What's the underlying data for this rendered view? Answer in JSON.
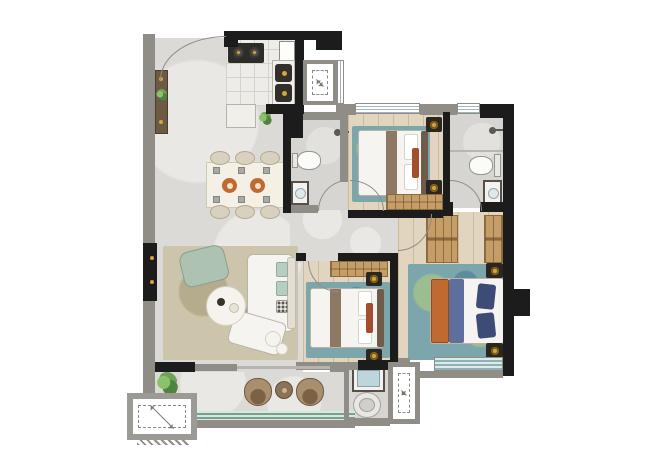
{
  "meta": {
    "type": "residential-floor-plan",
    "canvas": {
      "width": 651,
      "height": 460
    },
    "visible_text": "none"
  },
  "colors": {
    "wall-black": "#1c1c1c",
    "wall-gray": "#8f8d86",
    "floor-marble": "#dcdad6",
    "floor-marble-hi": "#eae8e5",
    "floor-tile": "#edece8",
    "tile-line": "#d5d2ca",
    "floor-bath": "#d7d5d1",
    "floor-wood": "#e2d5bf",
    "wood-line": "#cdbb9c",
    "rug-blue": "#7ca6ab",
    "rug-blue-green": "#9cbd8f",
    "rug-olive": "#ccc4ab",
    "furn-white": "#f6f4f0",
    "furn-border": "#b9b4a8",
    "wood-furn": "#c49e66",
    "wood-furn-dark": "#8a6a3e",
    "dark-unit": "#2b2620",
    "gold": "#d2a63c",
    "bed-runner": "#8d7963",
    "headboard": "#6f5b49",
    "accent-red": "#a34e2f",
    "navy": "#3c4c76",
    "orange": "#c06a32",
    "blue-blanket": "#5e6f9d",
    "mint": "#b7cdbf",
    "sage": "#aec2b2",
    "window-line": "#9fb4b9",
    "window-teal": "#8fb0b4",
    "rail-green": "#76a18c",
    "arc": "#8e8c84",
    "green-plant": "#6da355",
    "wicker": "#a98f6d",
    "wicker-dark": "#7c6245"
  },
  "rooms": [
    {
      "id": "entry",
      "furniture": [
        "entry-door-arc",
        "shoe-console",
        "plant"
      ]
    },
    {
      "id": "kitchen",
      "furniture": [
        "stove-2-burner",
        "fridge",
        "double-sink",
        "counters",
        "plant"
      ]
    },
    {
      "id": "dining-area",
      "furniture": [
        "dining-table",
        "six-chairs",
        "two-serving-plates"
      ]
    },
    {
      "id": "living-room",
      "furniture": [
        "l-shaped-sofa",
        "green-armchair",
        "round-coffee-table",
        "side-tables",
        "area-rug"
      ]
    },
    {
      "id": "guest-bathroom",
      "furniture": [
        "toilet",
        "washbasin",
        "shower-head"
      ]
    },
    {
      "id": "bedroom-top-right",
      "furniture": [
        "double-bed",
        "two-nightstands",
        "wardrobe",
        "blue-rug",
        "window"
      ]
    },
    {
      "id": "main-bathroom",
      "furniture": [
        "toilet",
        "washbasin",
        "shower-head",
        "window"
      ]
    },
    {
      "id": "corridor",
      "furniture": [
        "door-arcs"
      ]
    },
    {
      "id": "bedroom-middle",
      "furniture": [
        "double-bed",
        "two-nightstands",
        "wardrobe",
        "blue-rug"
      ]
    },
    {
      "id": "master-bedroom",
      "furniture": [
        "double-bed-orange-blue",
        "two-nightstands",
        "two-wardrobes",
        "blue-green-rug",
        "bay-window"
      ]
    },
    {
      "id": "laundry-niche",
      "furniture": [
        "washbasin",
        "washing-machine"
      ]
    },
    {
      "id": "balcony",
      "furniture": [
        "two-wicker-chairs",
        "round-side-table",
        "plant",
        "green-railing"
      ]
    },
    {
      "id": "ac-platforms",
      "furniture": [
        "dashed-ac-symbol-x3"
      ]
    }
  ],
  "symbols": {
    "door": "quarter-circle-arc",
    "window": "striped-band",
    "ac-platform": "dashed-square-with-diagonal-arrow",
    "shower": "shower-head-icon",
    "lamp": "gold-dot-on-dark-nightstand"
  }
}
